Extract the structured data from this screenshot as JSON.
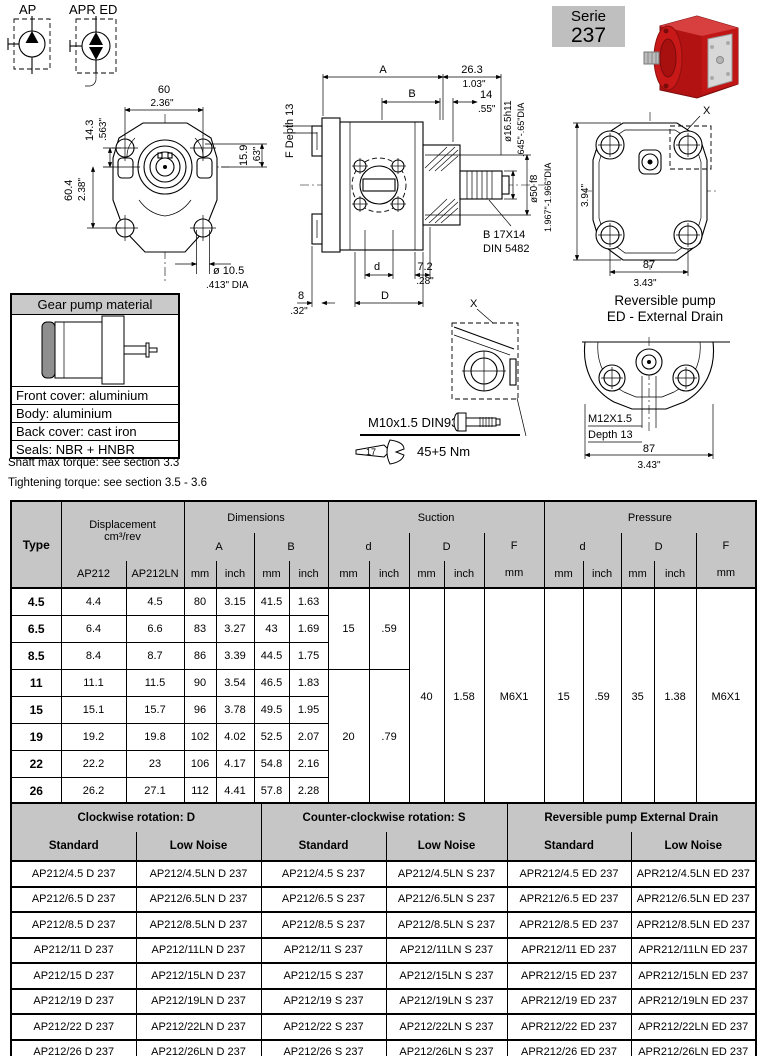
{
  "labels": {
    "ap": "AP",
    "apr_ed": "APR ED"
  },
  "serie": {
    "line1": "Serie",
    "line2": "237"
  },
  "front": {
    "width_mm": "60",
    "width_in": "2.36\"",
    "offset_mm": "14.3",
    "offset_in": ".563\"",
    "height_mm": "60.4",
    "height_in": "2.38\"",
    "side_mm": "15.9",
    "side_in": ".63\"",
    "hole_mm": "ø 10.5",
    "hole_in": ".413\" DIA"
  },
  "side": {
    "dim_a": "A",
    "dim_b": "B",
    "len1_mm": "26.3",
    "len1_in": "1.03\"",
    "len2_mm": "14",
    "len2_in": ".55\"",
    "shaft_dia": "ø16.5h11",
    "shaft_dia_in": ".645\"-.65\"DIA",
    "pilot_dia": "ø50 f8",
    "pilot_dia_in": "1.967\"-1.966\"DIA",
    "f_depth": "F Depth 13",
    "spline_line1": "B 17X14",
    "spline_line2": "DIN 5482",
    "dim_d_small": "d",
    "dim_d_big": "D",
    "len3_mm": "7.2",
    "len3_in": ".28\"",
    "len4_mm": "8",
    "len4_in": ".32\""
  },
  "rear": {
    "x": "X",
    "height_mm": "101",
    "height_in": "3.94\"",
    "width_mm": "87",
    "width_in": "3.43\""
  },
  "detail": {
    "x": "X",
    "bolt": "M10x1.5 DIN931",
    "wrench": "17",
    "torque": "45+5 Nm"
  },
  "reversible": {
    "title1": "Reversible pump",
    "title2": "ED - External Drain",
    "thread": "M12X1.5",
    "depth": "Depth 13",
    "width_mm": "87",
    "width_in": "3.43\""
  },
  "material": {
    "title": "Gear pump material",
    "rows": [
      "Front cover: aluminium",
      "Body: aluminium",
      "Back cover: cast iron",
      "Seals: NBR + HNBR"
    ]
  },
  "notes": [
    "Shaft max torque: see section 3.3",
    "Tightening torque: see section 3.5 - 3.6"
  ],
  "colors": {
    "header_gray": "#c6c6c6",
    "badge_gray": "#bfbfbf",
    "pump_red": "#c01616"
  },
  "main_table": {
    "header": {
      "type": "Type",
      "displacement1": "Displacement",
      "displacement2": "cm³/rev",
      "dimensions": "Dimensions",
      "suction": "Suction",
      "pressure": "Pressure",
      "a": "A",
      "b": "B",
      "d_small": "d",
      "d_big": "D",
      "f": "F",
      "mm": "mm",
      "inch": "inch",
      "ap212": "AP212",
      "ap212ln": "AP212LN"
    },
    "rows": [
      {
        "type": "4.5",
        "ap212": "4.4",
        "ap212ln": "4.5",
        "a_mm": "80",
        "a_inch": "3.15",
        "b_mm": "41.5",
        "b_inch": "1.63"
      },
      {
        "type": "6.5",
        "ap212": "6.4",
        "ap212ln": "6.6",
        "a_mm": "83",
        "a_inch": "3.27",
        "b_mm": "43",
        "b_inch": "1.69"
      },
      {
        "type": "8.5",
        "ap212": "8.4",
        "ap212ln": "8.7",
        "a_mm": "86",
        "a_inch": "3.39",
        "b_mm": "44.5",
        "b_inch": "1.75"
      },
      {
        "type": "11",
        "ap212": "11.1",
        "ap212ln": "11.5",
        "a_mm": "90",
        "a_inch": "3.54",
        "b_mm": "46.5",
        "b_inch": "1.83"
      },
      {
        "type": "15",
        "ap212": "15.1",
        "ap212ln": "15.7",
        "a_mm": "96",
        "a_inch": "3.78",
        "b_mm": "49.5",
        "b_inch": "1.95"
      },
      {
        "type": "19",
        "ap212": "19.2",
        "ap212ln": "19.8",
        "a_mm": "102",
        "a_inch": "4.02",
        "b_mm": "52.5",
        "b_inch": "2.07"
      },
      {
        "type": "22",
        "ap212": "22.2",
        "ap212ln": "23",
        "a_mm": "106",
        "a_inch": "4.17",
        "b_mm": "54.8",
        "b_inch": "2.16"
      },
      {
        "type": "26",
        "ap212": "26.2",
        "ap212ln": "27.1",
        "a_mm": "112",
        "a_inch": "4.41",
        "b_mm": "57.8",
        "b_inch": "2.28"
      }
    ],
    "suction": {
      "d": [
        {
          "mm": "15",
          "inch": ".59",
          "rows": 3
        },
        {
          "mm": "20",
          "inch": ".79",
          "rows": 5
        }
      ],
      "D": {
        "mm": "40",
        "inch": "1.58"
      },
      "F": "M6X1"
    },
    "pressure": {
      "d": {
        "mm": "15",
        "inch": ".59"
      },
      "D": {
        "mm": "35",
        "inch": "1.38"
      },
      "F": "M6X1"
    }
  },
  "part_table": {
    "groups": [
      "Clockwise rotation: D",
      "Counter-clockwise rotation: S",
      "Reversible pump External Drain"
    ],
    "standard": "Standard",
    "low_noise": "Low Noise",
    "rows": [
      [
        "AP212/4.5 D 237",
        "AP212/4.5LN D 237",
        "AP212/4.5 S 237",
        "AP212/4.5LN S 237",
        "APR212/4.5 ED 237",
        "APR212/4.5LN ED 237"
      ],
      [
        "AP212/6.5 D 237",
        "AP212/6.5LN D 237",
        "AP212/6.5 S 237",
        "AP212/6.5LN S 237",
        "APR212/6.5 ED 237",
        "APR212/6.5LN ED 237"
      ],
      [
        "AP212/8.5 D 237",
        "AP212/8.5LN D 237",
        "AP212/8.5 S 237",
        "AP212/8.5LN S 237",
        "APR212/8.5 ED 237",
        "APR212/8.5LN ED 237"
      ],
      [
        "AP212/11 D 237",
        "AP212/11LN D 237",
        "AP212/11 S 237",
        "AP212/11LN S 237",
        "APR212/11 ED 237",
        "APR212/11LN ED 237"
      ],
      [
        "AP212/15 D 237",
        "AP212/15LN D 237",
        "AP212/15 S 237",
        "AP212/15LN S 237",
        "APR212/15 ED 237",
        "APR212/15LN ED 237"
      ],
      [
        "AP212/19 D 237",
        "AP212/19LN D 237",
        "AP212/19 S 237",
        "AP212/19LN S 237",
        "APR212/19 ED 237",
        "APR212/19LN ED 237"
      ],
      [
        "AP212/22 D 237",
        "AP212/22LN D 237",
        "AP212/22 S 237",
        "AP212/22LN S 237",
        "APR212/22 ED 237",
        "APR212/22LN ED 237"
      ],
      [
        "AP212/26 D 237",
        "AP212/26LN D 237",
        "AP212/26 S 237",
        "AP212/26LN S 237",
        "APR212/26 ED 237",
        "APR212/26LN ED 237"
      ]
    ]
  }
}
